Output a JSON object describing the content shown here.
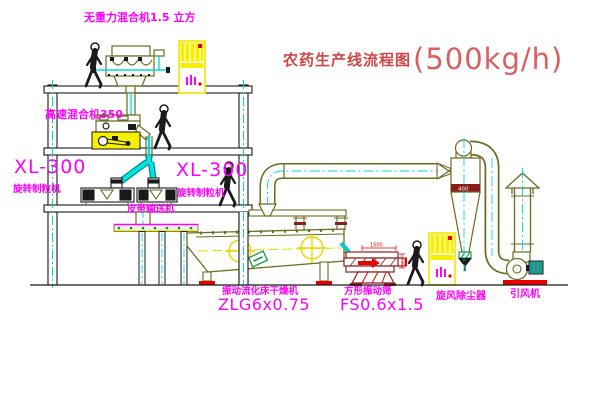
{
  "title": {
    "name": "农药生产线流程图",
    "capacity": "(500kg/h)"
  },
  "labels": {
    "top_mixer": "无重力混合机1.5 立方",
    "high_speed_mixer": "高速混合机350",
    "granulator_left": {
      "model": "XL-300",
      "name": "旋转制粒机"
    },
    "granulator_right": {
      "model": "XL-300",
      "name": "旋转制粒机"
    },
    "belt_conveyor": "皮带输送机",
    "dryer": {
      "name": "振动流化床干燥机",
      "model": "ZLG6x0.75"
    },
    "screen": {
      "name": "方形振动筛",
      "model": "FS0.6x1.5"
    },
    "cyclone": "旋风除尘器",
    "fan": "引风机"
  },
  "dimensions": {
    "screen_length": "1500",
    "screen_height": "550",
    "cyclone_band": "400"
  },
  "colors": {
    "label_magenta": "#ff00ff",
    "title_red": "#cf4646",
    "equipment_olive": "#6b6b22",
    "highlight_yellow": "#f7ef00",
    "centerline_cyan": "#00d9d9",
    "screen_maroon": "#8b1f1f",
    "accent_red": "#e60000",
    "motor_teal": "#2aa198"
  }
}
